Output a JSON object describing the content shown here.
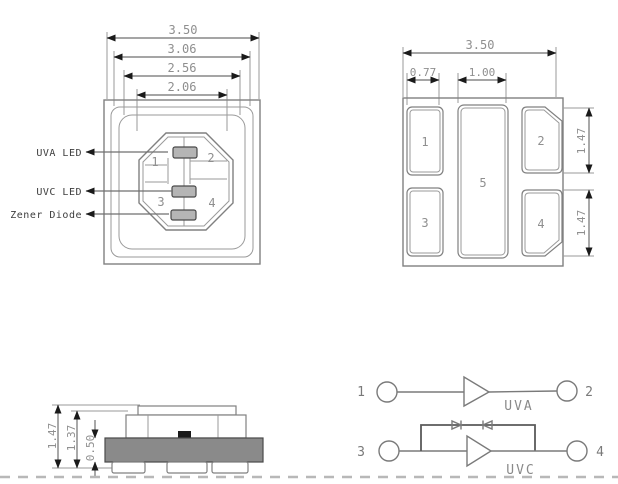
{
  "drawing": {
    "colors": {
      "line": "#808080",
      "dim_text": "#8f8f8f",
      "arrow": "#1a1a1a",
      "body_fill": "#8a8a8a",
      "die_fill": "#b5b5b5",
      "black_die": "#1a1a1a",
      "dashed_border": "#b8b8b8"
    },
    "top_view": {
      "dimensions": [
        "3.50",
        "3.06",
        "2.56",
        "2.06"
      ],
      "labels": [
        "UVA LED",
        "UVC LED",
        "Zener Diode"
      ],
      "pad_numbers": [
        "1",
        "2",
        "3",
        "4"
      ]
    },
    "bottom_view": {
      "dim_overall": "3.50",
      "dim_pad1_width": "0.77",
      "dim_pad5_width": "1.00",
      "dim_pad2_height": "1.47",
      "dim_pad4_height": "1.47",
      "pad_numbers": [
        "1",
        "2",
        "3",
        "4",
        "5"
      ]
    },
    "side_view": {
      "dims": [
        "1.47",
        "1.37",
        "0.50"
      ]
    },
    "circuit": {
      "uva": {
        "pin_left": "1",
        "pin_right": "2",
        "label": "UVA"
      },
      "uvc": {
        "pin_left": "3",
        "pin_right": "4",
        "label": "UVC"
      }
    }
  }
}
